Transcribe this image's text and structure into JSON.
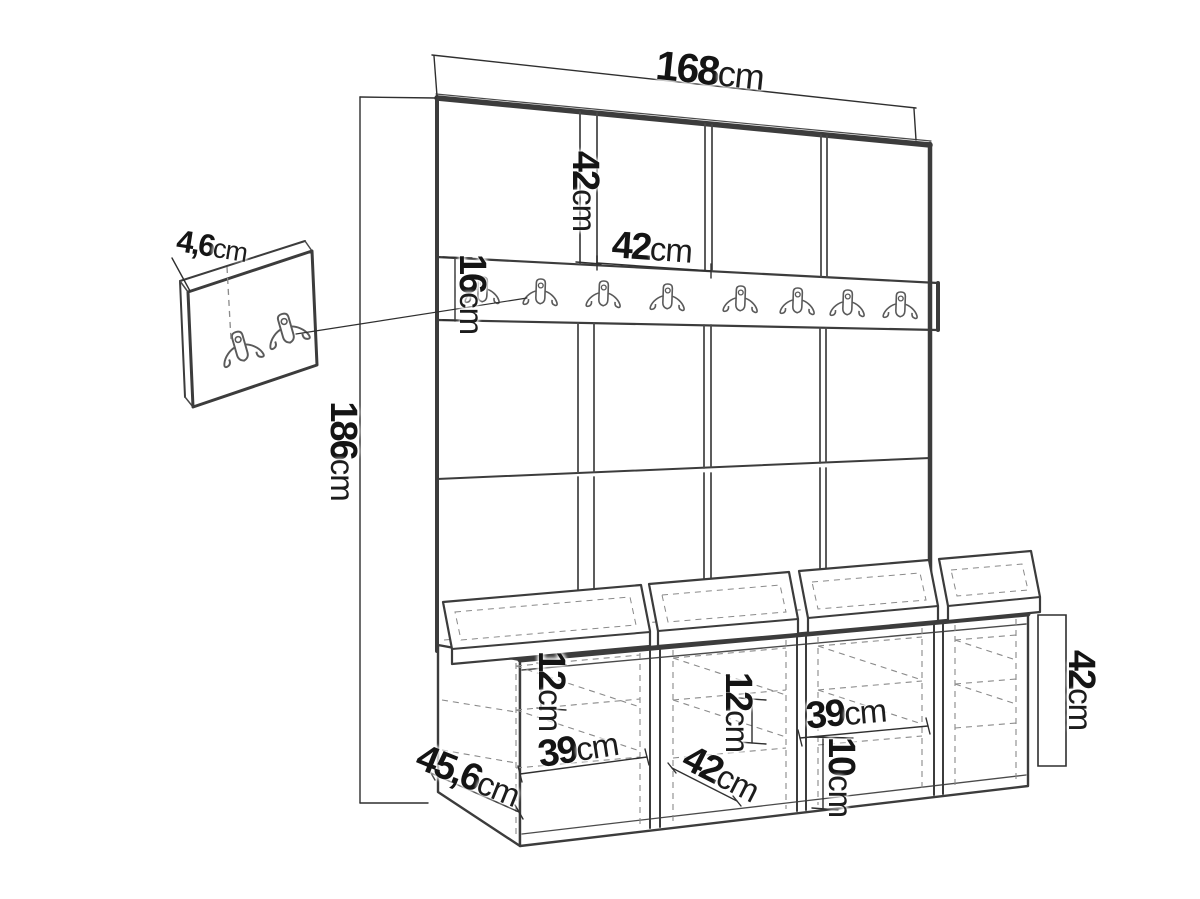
{
  "diagram": {
    "type": "furniture-dimension-drawing",
    "units": "cm",
    "colors": {
      "background": "#ffffff",
      "line": "#3c3c3c",
      "dashed": "#8a8a8a",
      "text": "#141414"
    },
    "wall_unit": {
      "name": "upholstered-panel-wall-with-hook-rail",
      "panel_columns": 4,
      "panel_rows": 3,
      "rail_hooks": 8,
      "dims": {
        "total_width": {
          "num": "168",
          "unit": "cm"
        },
        "total_height": {
          "num": "186",
          "unit": "cm"
        },
        "panel_height": {
          "num": "42",
          "unit": "cm"
        },
        "panel_width": {
          "num": "42",
          "unit": "cm"
        },
        "rail_height": {
          "num": "16",
          "unit": "cm"
        }
      }
    },
    "hook_panel": {
      "name": "wall-hook-panel-detail",
      "hooks": 2,
      "dims": {
        "depth": {
          "num": "4,6",
          "unit": "cm"
        }
      }
    },
    "bench": {
      "name": "shoe-bench-with-cushions",
      "compartments": 4,
      "cushions": 4,
      "dims": {
        "height": {
          "num": "42",
          "unit": "cm"
        },
        "depth": {
          "num": "45,6",
          "unit": "cm"
        },
        "left_shelf_spacing": {
          "num": "12",
          "unit": "cm"
        },
        "left_compartment_width": {
          "num": "39",
          "unit": "cm"
        },
        "middle_shelf_spacing": {
          "num": "12",
          "unit": "cm"
        },
        "middle_compartment_width": {
          "num": "42",
          "unit": "cm"
        },
        "right_compartment_width": {
          "num": "39",
          "unit": "cm"
        },
        "right_bottom_clearance": {
          "num": "10",
          "unit": "cm"
        }
      }
    }
  }
}
